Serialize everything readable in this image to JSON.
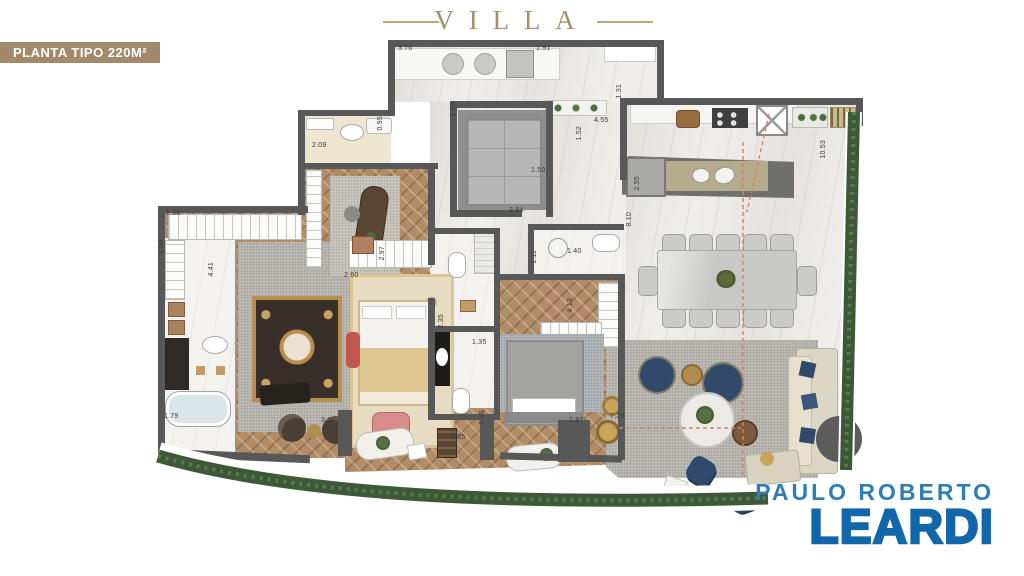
{
  "header": {
    "brand": "VILLA",
    "badge": "PLANTA TIPO 220M²"
  },
  "footer_logo": {
    "line1": "PAULO ROBERTO",
    "line2": "LEARDI"
  },
  "colors": {
    "gold": "#a5906a",
    "badge": "#a3886b",
    "wall": "#585858",
    "hedge": "#3c5836",
    "logoLight": "#2e7cb8",
    "logoDark": "#1267ab",
    "redline": "#d4826a"
  },
  "plan": {
    "dimension_labels": [
      {
        "v": "3.76",
        "x": 398,
        "y": 45,
        "o": "h"
      },
      {
        "v": "1.91",
        "x": 536,
        "y": 45,
        "o": "h"
      },
      {
        "v": "1.31",
        "x": 616,
        "y": 84,
        "o": "v"
      },
      {
        "v": "4.55",
        "x": 594,
        "y": 117,
        "o": "h"
      },
      {
        "v": "1.52",
        "x": 576,
        "y": 126,
        "o": "v"
      },
      {
        "v": "1.50",
        "x": 531,
        "y": 167,
        "o": "h"
      },
      {
        "v": "1.99",
        "x": 450,
        "y": 102,
        "o": "v"
      },
      {
        "v": "0.95",
        "x": 377,
        "y": 116,
        "o": "v"
      },
      {
        "v": "2.09",
        "x": 312,
        "y": 142,
        "o": "h"
      },
      {
        "v": "3.84",
        "x": 509,
        "y": 207,
        "o": "h"
      },
      {
        "v": "6.36",
        "x": 166,
        "y": 210,
        "o": "h"
      },
      {
        "v": "1.50",
        "x": 158,
        "y": 240,
        "o": "v"
      },
      {
        "v": "4.41",
        "x": 208,
        "y": 262,
        "o": "v"
      },
      {
        "v": "1.79",
        "x": 164,
        "y": 413,
        "o": "h"
      },
      {
        "v": "2.97",
        "x": 379,
        "y": 246,
        "o": "v"
      },
      {
        "v": "2.60",
        "x": 344,
        "y": 272,
        "o": "h"
      },
      {
        "v": "2.35",
        "x": 438,
        "y": 314,
        "o": "v"
      },
      {
        "v": "1.35",
        "x": 472,
        "y": 339,
        "o": "h"
      },
      {
        "v": "1.11",
        "x": 531,
        "y": 250,
        "o": "v"
      },
      {
        "v": "1.40",
        "x": 567,
        "y": 248,
        "o": "h"
      },
      {
        "v": "4.13",
        "x": 567,
        "y": 298,
        "o": "v"
      },
      {
        "v": "2.45",
        "x": 479,
        "y": 410,
        "o": "v"
      },
      {
        "v": "5.65",
        "x": 451,
        "y": 434,
        "o": "h"
      },
      {
        "v": "3.00",
        "x": 321,
        "y": 417,
        "o": "h"
      },
      {
        "v": "2.87",
        "x": 569,
        "y": 417,
        "o": "h"
      },
      {
        "v": "7.20",
        "x": 610,
        "y": 413,
        "o": "h"
      },
      {
        "v": "2.55",
        "x": 634,
        "y": 176,
        "o": "v"
      },
      {
        "v": "8.10",
        "x": 626,
        "y": 212,
        "o": "v"
      },
      {
        "v": "10.53",
        "x": 820,
        "y": 140,
        "o": "v"
      }
    ]
  }
}
